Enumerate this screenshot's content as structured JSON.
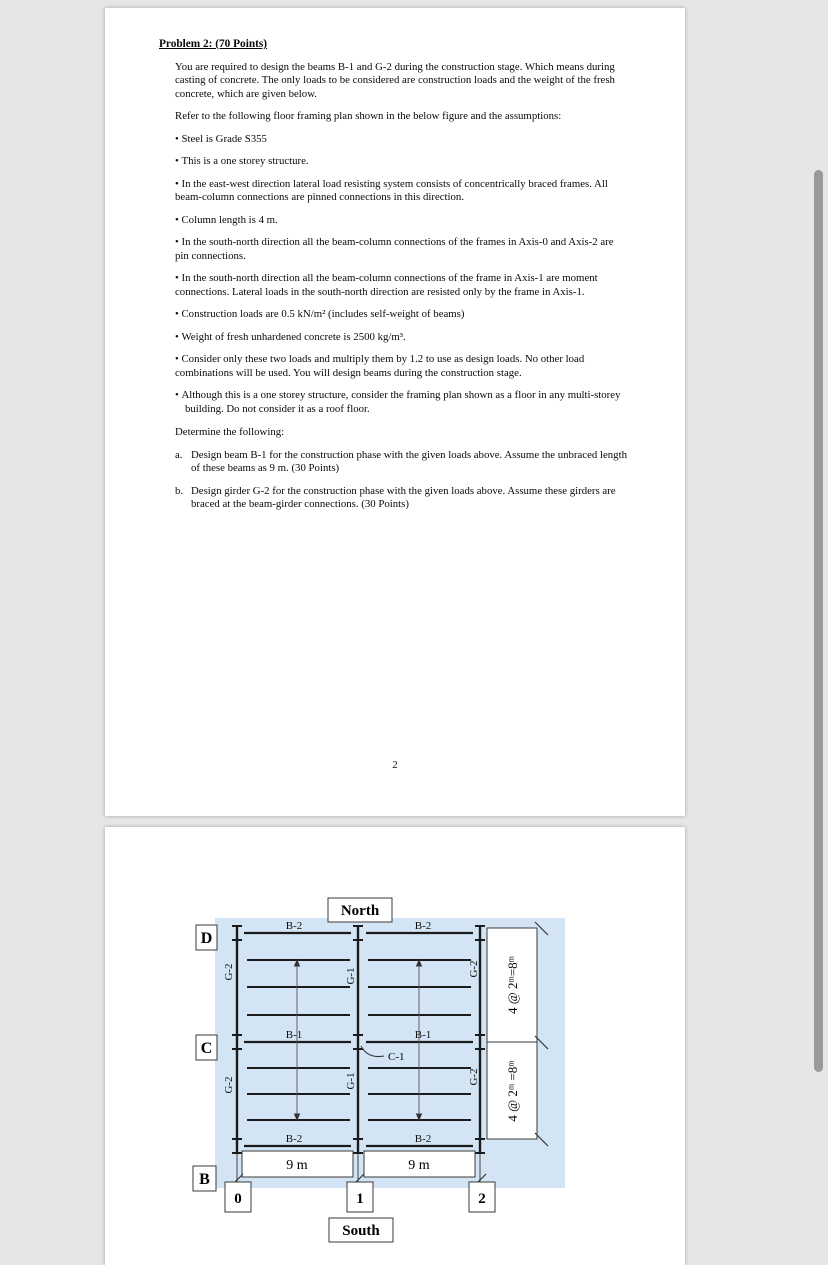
{
  "page1": {
    "title": "Problem 2: (70 Points)",
    "paragraphs": {
      "intro": "You are required to design the beams B-1 and G-2 during the construction stage. Which means during casting of concrete. The only loads to be considered are construction loads and the weight of the fresh concrete, which are given below.",
      "refer": "Refer to the following floor framing plan shown in the below figure and the assumptions:"
    },
    "bullets": [
      "Steel is Grade S355",
      "This is a one storey structure.",
      "In the east-west direction lateral load resisting system consists of concentrically braced frames. All beam-column connections are pinned connections in this direction.",
      "Column length is 4 m.",
      "In the south-north direction all the beam-column connections of the frames in Axis-0 and Axis-2 are pin connections.",
      "In the south-north direction all the beam-column connections of the frame in Axis-1 are moment connections. Lateral loads in the south-north direction are resisted only by the frame in Axis-1.",
      "Construction loads are 0.5 kN/m² (includes self-weight of beams)",
      "Weight of fresh unhardened concrete is 2500 kg/m³.",
      "Consider only these two loads and multiply them by 1.2 to use as design loads. No other load combinations will be used. You will design beams during the construction stage.",
      "Although this is a one storey structure, consider the framing plan shown as a floor in any multi-storey building. Do not consider it as a roof floor."
    ],
    "determine": "Determine the following:",
    "items": [
      {
        "label": "a.",
        "text": "Design beam B-1 for the construction phase with the given loads above. Assume the unbraced length of these beams as 9 m. (30 Points)"
      },
      {
        "label": "b.",
        "text": "Design girder G-2 for the construction phase with the given loads above. Assume these girders are braced at the beam-girder connections. (30 Points)"
      }
    ],
    "page_number": "2"
  },
  "page2": {
    "diagram": {
      "north": "North",
      "south": "South",
      "row_labels": [
        "D",
        "C",
        "B"
      ],
      "axis_labels": [
        "0",
        "1",
        "2"
      ],
      "beam_labels": {
        "top": [
          "B-2",
          "B-2"
        ],
        "middle": [
          "B-1",
          "B-1"
        ],
        "bottom": [
          "B-2",
          "B-2"
        ]
      },
      "girder_labels": {
        "upper": [
          "G-2",
          "G-1",
          "G-2"
        ],
        "lower": [
          "G-2",
          "G-1",
          "G-2"
        ]
      },
      "column_label": "C-1",
      "span_dims": [
        "9 m",
        "9 m"
      ],
      "height_dims": [
        "4 @ 2ᵐ=8ᵐ",
        "4 @ 2ᵐ =8ᵐ"
      ],
      "colors": {
        "plan_bg": "#d3e5f4",
        "line": "#1b1b1b"
      }
    }
  }
}
